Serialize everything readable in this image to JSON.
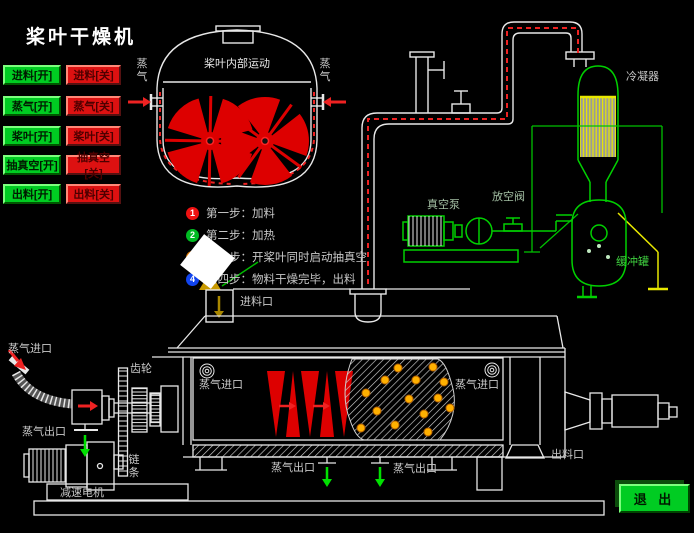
{
  "app": {
    "title": "桨叶干燥机"
  },
  "controls": {
    "open": [
      "进料[开]",
      "蒸气[开]",
      "桨叶[开]",
      "抽真空[开]",
      "出料[开]"
    ],
    "close": [
      "进料[关]",
      "蒸气[关]",
      "桨叶[关]",
      "抽真空[关]",
      "出料[关]"
    ],
    "exit_label": "退 出"
  },
  "steps": [
    {
      "num": "1",
      "color": "#ee1111",
      "text": "第一步：加料"
    },
    {
      "num": "2",
      "color": "#00bb22",
      "text": "第二步：加热"
    },
    {
      "num": "3",
      "color": "#dd7700",
      "text": "第三步：开桨叶同时启动抽真空"
    },
    {
      "num": "4",
      "color": "#1144ee",
      "text": "第四步：物料干燥完毕，出料"
    }
  ],
  "labels": {
    "vessel_motion": "桨叶内部运动",
    "steam_vert": "蒸气",
    "condenser": "冷凝器",
    "vacuum_pump": "真空泵",
    "vent_valve": "放空阀",
    "buffer_tank": "缓冲罐",
    "feed_port": "进料口",
    "discharge_port": "出料口",
    "steam_inlet": "蒸气进口",
    "steam_outlet": "蒸气出口",
    "gear": "齿轮",
    "chain": "链条",
    "reducer_motor": "减速电机"
  },
  "colors": {
    "line_white": "#e8e8e8",
    "equipment_green": "#00d000",
    "paddle_red": "#dd0000",
    "steam_dash_red": "#ee2222",
    "frame_yellow": "#e8e800",
    "dot_orange": "#ffb000",
    "button_green": "#00cc22",
    "button_red": "#dd1111"
  }
}
